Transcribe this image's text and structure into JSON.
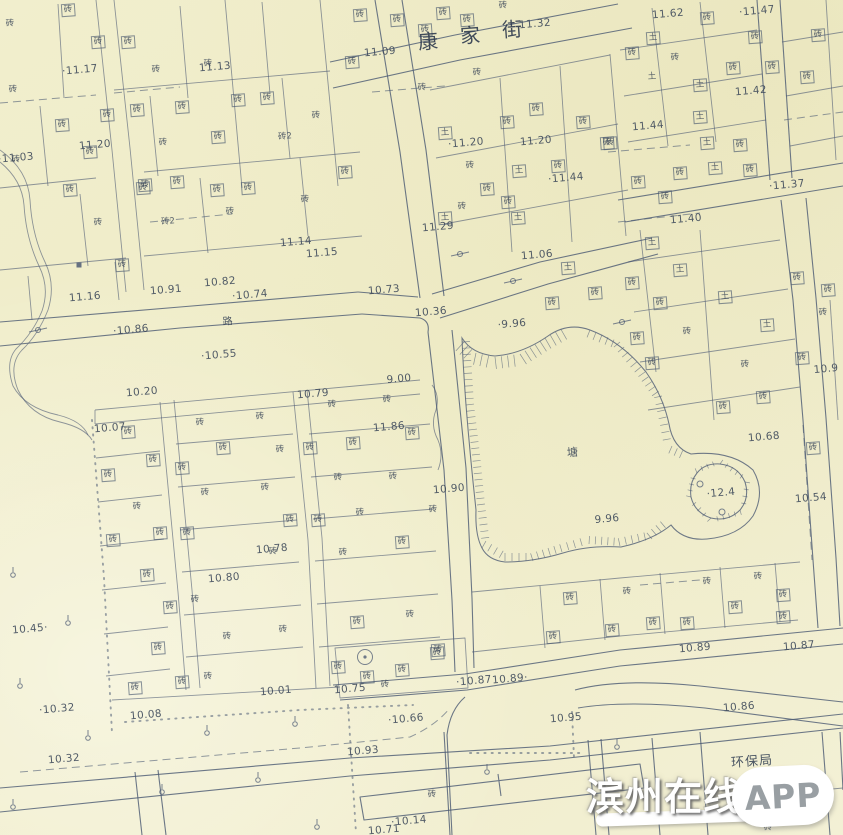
{
  "map": {
    "street_name": "康家街",
    "street_name_chars": [
      {
        "ch": "康",
        "x": 428,
        "y": 40
      },
      {
        "ch": "家",
        "x": 470,
        "y": 34
      },
      {
        "ch": "街",
        "x": 512,
        "y": 28
      }
    ],
    "area_labels": [
      {
        "text": "塘",
        "x": 573,
        "y": 452,
        "size": 11
      },
      {
        "text": "路",
        "x": 228,
        "y": 320,
        "size": 10
      },
      {
        "text": "环保局",
        "x": 752,
        "y": 760,
        "size": 13
      }
    ],
    "spot_elevations": [
      [
        "·11.17",
        80,
        70
      ],
      [
        "11.13",
        215,
        67
      ],
      [
        "·11.03",
        16,
        158
      ],
      [
        "11.20",
        95,
        145
      ],
      [
        "11.16",
        85,
        297
      ],
      [
        "10.91",
        166,
        290
      ],
      [
        "10.82",
        220,
        282
      ],
      [
        "·10.74",
        250,
        295
      ],
      [
        "11.14",
        296,
        242
      ],
      [
        "11.15",
        322,
        253
      ],
      [
        "·10.86",
        131,
        330
      ],
      [
        "·10.55",
        219,
        355
      ],
      [
        "11.09",
        380,
        52
      ],
      [
        "11.32",
        535,
        24
      ],
      [
        "·11.20",
        466,
        143
      ],
      [
        "11.20",
        536,
        141
      ],
      [
        "11.29",
        438,
        227
      ],
      [
        "·11.44",
        566,
        178
      ],
      [
        "11.44",
        648,
        126
      ],
      [
        "11.62",
        668,
        14
      ],
      [
        "·11.47",
        757,
        11
      ],
      [
        "11.42",
        751,
        91
      ],
      [
        "·11.37",
        787,
        185
      ],
      [
        "11.40",
        686,
        219
      ],
      [
        "11.06",
        537,
        255
      ],
      [
        "10.73",
        384,
        290
      ],
      [
        "10.36",
        431,
        312
      ],
      [
        "·9.96",
        512,
        324
      ],
      [
        "9.00",
        399,
        379
      ],
      [
        "10.79",
        313,
        394
      ],
      [
        "10.20",
        142,
        392
      ],
      [
        "10.07",
        110,
        428
      ],
      [
        "11.86",
        389,
        427
      ],
      [
        "10.90",
        449,
        489
      ],
      [
        "10.68",
        764,
        437
      ],
      [
        "·12.4",
        721,
        493
      ],
      [
        "10.54",
        811,
        498
      ],
      [
        "9.96",
        607,
        519
      ],
      [
        "10.78",
        272,
        549
      ],
      [
        "10.80",
        224,
        578
      ],
      [
        "10.45·",
        30,
        629
      ],
      [
        "10.89",
        695,
        648
      ],
      [
        "10.87",
        799,
        646
      ],
      [
        "·10.32",
        57,
        709
      ],
      [
        "10.08",
        146,
        715
      ],
      [
        "10.01",
        276,
        691
      ],
      [
        "10.75",
        350,
        689
      ],
      [
        "·10.87",
        474,
        681
      ],
      [
        "10.89·",
        510,
        679
      ],
      [
        "·10.66",
        406,
        719
      ],
      [
        "10.95",
        566,
        718
      ],
      [
        "10.86",
        739,
        707
      ],
      [
        "10.93",
        363,
        751
      ],
      [
        "10.32",
        64,
        759
      ],
      [
        "·10.14",
        409,
        821
      ],
      [
        "10.71",
        384,
        830
      ],
      [
        "10.9",
        826,
        369
      ]
    ],
    "building_labels": [
      [
        "砖",
        68,
        10,
        1
      ],
      [
        "砖",
        10,
        24,
        0
      ],
      [
        "砖",
        98,
        42,
        1
      ],
      [
        "砖",
        128,
        42,
        1
      ],
      [
        "砖",
        13,
        90,
        0
      ],
      [
        "砖",
        156,
        70,
        0
      ],
      [
        "砖",
        208,
        64,
        0
      ],
      [
        "砖",
        16,
        160,
        0
      ],
      [
        "砖",
        62,
        125,
        1
      ],
      [
        "砖",
        107,
        115,
        1
      ],
      [
        "砖",
        137,
        110,
        1
      ],
      [
        "砖",
        182,
        107,
        1
      ],
      [
        "砖",
        238,
        100,
        1
      ],
      [
        "砖",
        267,
        98,
        1
      ],
      [
        "砖",
        90,
        152,
        1
      ],
      [
        "砖",
        163,
        143,
        0
      ],
      [
        "砖",
        218,
        137,
        1
      ],
      [
        "砖",
        70,
        190,
        1
      ],
      [
        "砖",
        145,
        185,
        1
      ],
      [
        "砖",
        177,
        182,
        1
      ],
      [
        "砖",
        98,
        223,
        0
      ],
      [
        "砖",
        143,
        188,
        1
      ],
      [
        "砖",
        217,
        190,
        1
      ],
      [
        "砖",
        248,
        188,
        1
      ],
      [
        "砖",
        230,
        212,
        0
      ],
      [
        "砖",
        122,
        265,
        1
      ],
      [
        "砖2",
        285,
        137,
        0
      ],
      [
        "砖2",
        168,
        222,
        0
      ],
      [
        "砖",
        305,
        200,
        0
      ],
      [
        "砖",
        345,
        172,
        1
      ],
      [
        "砖",
        316,
        116,
        0
      ],
      [
        "砖",
        352,
        62,
        1
      ],
      [
        "砖",
        360,
        15,
        1
      ],
      [
        "砖",
        397,
        20,
        1
      ],
      [
        "砖",
        425,
        30,
        1
      ],
      [
        "砖",
        443,
        13,
        1
      ],
      [
        "砖",
        467,
        20,
        1
      ],
      [
        "砖",
        503,
        6,
        0
      ],
      [
        "砖",
        477,
        73,
        0
      ],
      [
        "砖",
        422,
        88,
        0
      ],
      [
        "土",
        445,
        133,
        1
      ],
      [
        "砖",
        507,
        122,
        1
      ],
      [
        "砖",
        536,
        109,
        1
      ],
      [
        "砖",
        583,
        122,
        1
      ],
      [
        "砖",
        607,
        143,
        1
      ],
      [
        "土",
        519,
        171,
        1
      ],
      [
        "砖",
        470,
        166,
        0
      ],
      [
        "砖",
        487,
        189,
        1
      ],
      [
        "砖",
        558,
        166,
        1
      ],
      [
        "砖",
        508,
        202,
        1
      ],
      [
        "土",
        518,
        218,
        1
      ],
      [
        "砖",
        462,
        207,
        0
      ],
      [
        "土",
        445,
        218,
        1
      ],
      [
        "土",
        653,
        38,
        1
      ],
      [
        "砖",
        707,
        18,
        1
      ],
      [
        "砖",
        755,
        37,
        1
      ],
      [
        "砖",
        632,
        53,
        1
      ],
      [
        "砖",
        675,
        58,
        0
      ],
      [
        "土",
        652,
        77,
        0
      ],
      [
        "砖",
        818,
        35,
        1
      ],
      [
        "土",
        700,
        85,
        1
      ],
      [
        "砖",
        733,
        68,
        1
      ],
      [
        "砖",
        772,
        67,
        1
      ],
      [
        "砖",
        807,
        77,
        1
      ],
      [
        "土",
        700,
        117,
        1
      ],
      [
        "砖",
        740,
        145,
        1
      ],
      [
        "土",
        707,
        143,
        1
      ],
      [
        "砖",
        610,
        143,
        1
      ],
      [
        "土",
        715,
        168,
        1
      ],
      [
        "砖",
        750,
        170,
        1
      ],
      [
        "砖",
        680,
        173,
        1
      ],
      [
        "砖",
        638,
        182,
        1
      ],
      [
        "砖",
        665,
        197,
        1
      ],
      [
        "土",
        680,
        270,
        1
      ],
      [
        "砖",
        632,
        283,
        1
      ],
      [
        "砖",
        660,
        303,
        1
      ],
      [
        "土",
        725,
        297,
        1
      ],
      [
        "砖",
        797,
        278,
        1
      ],
      [
        "砖",
        828,
        290,
        1
      ],
      [
        "砖",
        637,
        338,
        1
      ],
      [
        "砖",
        687,
        332,
        0
      ],
      [
        "土",
        767,
        325,
        1
      ],
      [
        "砖",
        823,
        313,
        0
      ],
      [
        "砖",
        652,
        363,
        1
      ],
      [
        "砖",
        802,
        358,
        1
      ],
      [
        "砖",
        745,
        365,
        0
      ],
      [
        "砖",
        763,
        397,
        1
      ],
      [
        "砖",
        723,
        407,
        1
      ],
      [
        "土",
        652,
        243,
        1
      ],
      [
        "土",
        568,
        268,
        1
      ],
      [
        "砖",
        595,
        293,
        1
      ],
      [
        "砖",
        552,
        303,
        1
      ],
      [
        "砖",
        813,
        448,
        1
      ],
      [
        "砖",
        570,
        598,
        1
      ],
      [
        "砖",
        627,
        592,
        0
      ],
      [
        "砖",
        553,
        637,
        1
      ],
      [
        "砖",
        612,
        630,
        1
      ],
      [
        "砖",
        653,
        623,
        1
      ],
      [
        "砖",
        687,
        623,
        1
      ],
      [
        "砖",
        735,
        607,
        1
      ],
      [
        "砖",
        707,
        582,
        0
      ],
      [
        "砖",
        758,
        577,
        0
      ],
      [
        "砖",
        783,
        595,
        1
      ],
      [
        "砖",
        783,
        617,
        1
      ],
      [
        "砖",
        128,
        432,
        1
      ],
      [
        "砖",
        108,
        475,
        1
      ],
      [
        "砖",
        153,
        460,
        1
      ],
      [
        "砖",
        182,
        468,
        1
      ],
      [
        "砖",
        137,
        507,
        0
      ],
      [
        "砖",
        113,
        540,
        1
      ],
      [
        "砖",
        160,
        533,
        1
      ],
      [
        "砖",
        187,
        533,
        1
      ],
      [
        "砖",
        147,
        575,
        1
      ],
      [
        "砖",
        200,
        423,
        0
      ],
      [
        "砖",
        223,
        448,
        1
      ],
      [
        "砖",
        260,
        417,
        0
      ],
      [
        "砖",
        280,
        450,
        0
      ],
      [
        "砖",
        310,
        448,
        1
      ],
      [
        "砖",
        332,
        405,
        0
      ],
      [
        "砖",
        353,
        443,
        1
      ],
      [
        "砖",
        387,
        400,
        0
      ],
      [
        "砖",
        412,
        433,
        1
      ],
      [
        "砖",
        393,
        477,
        0
      ],
      [
        "砖",
        338,
        478,
        0
      ],
      [
        "砖",
        265,
        488,
        0
      ],
      [
        "砖",
        205,
        493,
        0
      ],
      [
        "砖",
        290,
        520,
        1
      ],
      [
        "砖",
        318,
        520,
        1
      ],
      [
        "砖",
        360,
        513,
        0
      ],
      [
        "砖",
        402,
        542,
        1
      ],
      [
        "砖",
        273,
        552,
        0
      ],
      [
        "砖",
        343,
        553,
        0
      ],
      [
        "砖",
        170,
        607,
        1
      ],
      [
        "砖",
        195,
        600,
        0
      ],
      [
        "砖",
        158,
        648,
        1
      ],
      [
        "砖",
        135,
        688,
        1
      ],
      [
        "砖",
        182,
        682,
        1
      ],
      [
        "砖",
        208,
        677,
        0
      ],
      [
        "砖",
        227,
        637,
        0
      ],
      [
        "砖",
        283,
        630,
        0
      ],
      [
        "砖",
        338,
        667,
        1
      ],
      [
        "砖",
        367,
        677,
        1
      ],
      [
        "砖",
        385,
        685,
        0
      ],
      [
        "砖",
        402,
        670,
        1
      ],
      [
        "砖",
        437,
        653,
        1
      ],
      [
        "砖",
        357,
        622,
        1
      ],
      [
        "砖",
        410,
        615,
        0
      ],
      [
        "砖",
        438,
        650,
        1
      ],
      [
        "砖",
        433,
        510,
        0
      ],
      [
        "砖",
        432,
        795,
        0
      ],
      [
        "砖",
        768,
        828,
        0
      ]
    ]
  },
  "symbols": {
    "grass": [
      {
        "x": 13,
        "y": 575
      },
      {
        "x": 68,
        "y": 623
      },
      {
        "x": 20,
        "y": 686
      },
      {
        "x": 88,
        "y": 738
      },
      {
        "x": 207,
        "y": 733
      },
      {
        "x": 295,
        "y": 724
      },
      {
        "x": 162,
        "y": 792
      },
      {
        "x": 258,
        "y": 780
      },
      {
        "x": 317,
        "y": 827
      },
      {
        "x": 13,
        "y": 807
      },
      {
        "x": 487,
        "y": 772
      },
      {
        "x": 617,
        "y": 747
      }
    ],
    "wells": [
      {
        "x": 365,
        "y": 657
      }
    ],
    "benchmarks": [
      {
        "x": 38,
        "y": 330
      },
      {
        "x": 460,
        "y": 254
      },
      {
        "x": 513,
        "y": 281
      },
      {
        "x": 622,
        "y": 322
      }
    ],
    "control_points": [
      {
        "x": 79,
        "y": 265
      }
    ],
    "island_dots": [
      {
        "x": 700,
        "y": 484
      },
      {
        "x": 722,
        "y": 512
      }
    ]
  },
  "watermark": {
    "site_name": "滨州在线",
    "suffix": "APP"
  },
  "colors": {
    "paper": "#f0ecca",
    "ink": "#4d5b74",
    "label_ink": "#3b4759",
    "watermark_text": "#ffffff",
    "watermark_app_text": "#999fa3"
  }
}
